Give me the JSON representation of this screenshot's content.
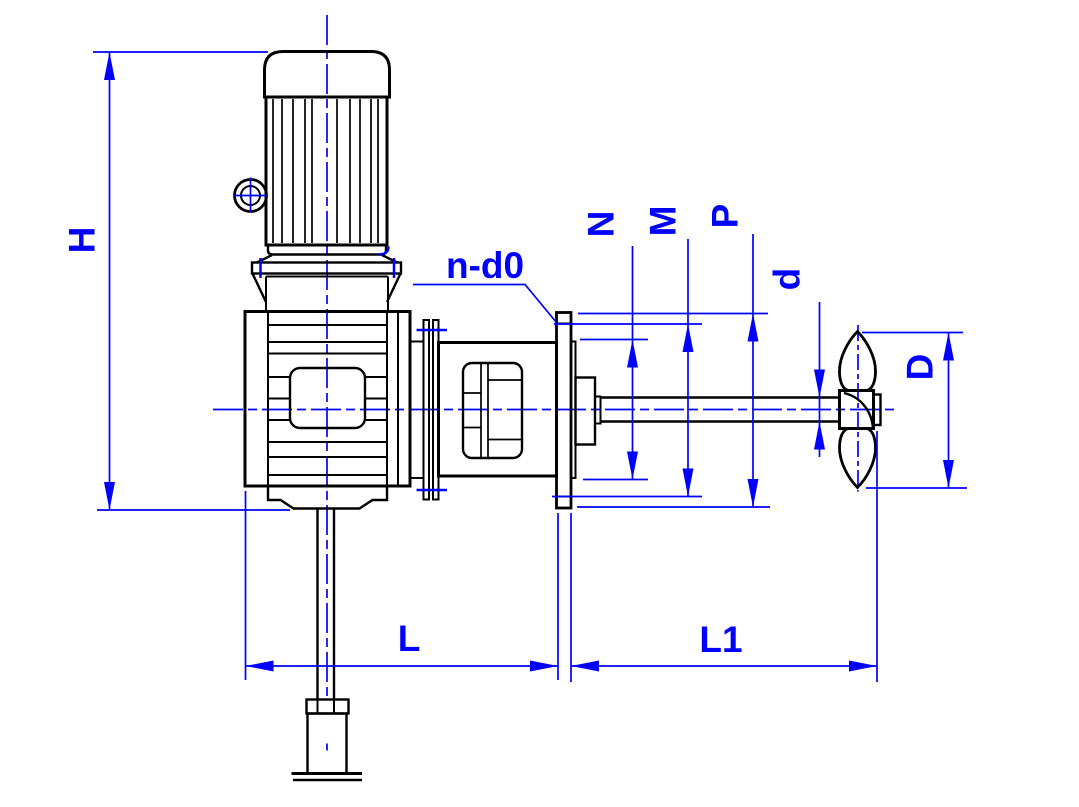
{
  "drawing": {
    "labels": {
      "H": "H",
      "L": "L",
      "L1": "L1",
      "N": "N",
      "M": "M",
      "P": "P",
      "d": "d",
      "D": "D",
      "bolt_pattern": "n-d0"
    },
    "colors": {
      "dimension_blue": "#0000ff",
      "geometry_black": "#000000",
      "background": "#ffffff"
    }
  }
}
